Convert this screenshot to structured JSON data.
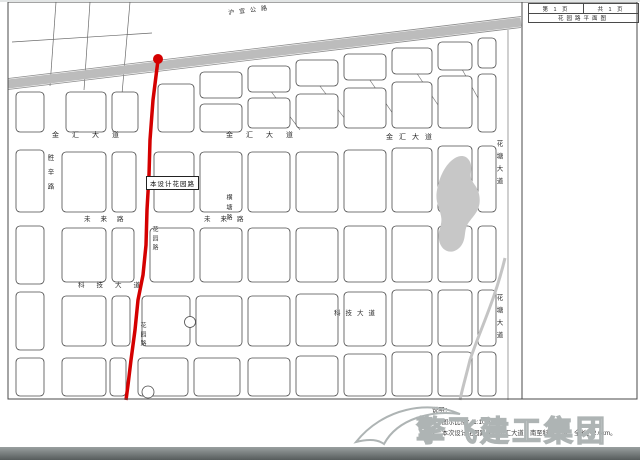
{
  "titleblock": {
    "page_label": "第 1 页",
    "total_label": "共 1 页",
    "drawing_title": "花园路平面图"
  },
  "map": {
    "design_label": "本设计花园路",
    "roads": {
      "jinhui": "金汇大道",
      "weilai": "未来路",
      "keji": "科技大道",
      "huatang": "花塘大道",
      "huayuan": "花园路",
      "shengxin": "胜辛路",
      "hengtang": "横塘路",
      "huyi": "沪宜公路"
    }
  },
  "notes": {
    "heading": "说明：",
    "items": [
      "1、图示比例：1:10000。",
      "2、本次设计花园路北起金汇大道，南至科技大道，全长约2.6km。"
    ]
  },
  "watermark": {
    "text": "擎飞建工集团"
  },
  "colors": {
    "route": "#d40000",
    "band": "#bcbcbc",
    "water": "#c7c7c7",
    "watermark_gray": "#aeb4b4"
  }
}
